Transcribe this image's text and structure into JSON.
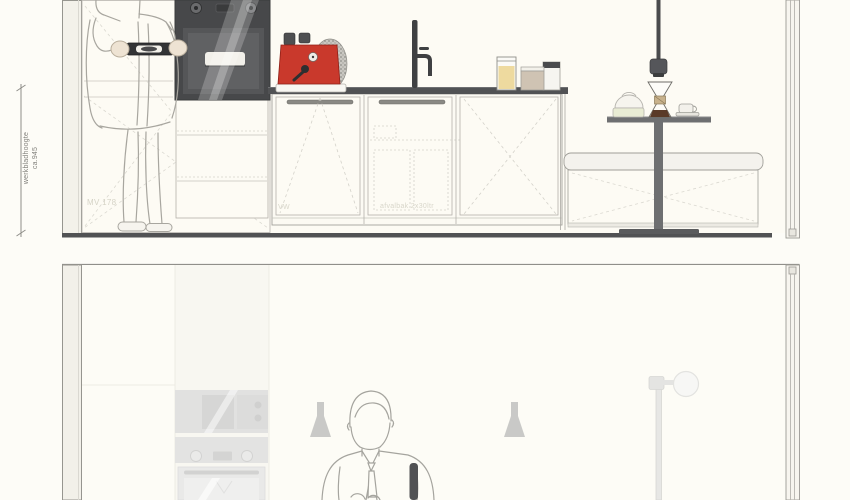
{
  "sheet": {
    "type": "kitchen-interior-elevation-drawing",
    "panels": [
      "front-elevation-with-figure",
      "side-elevation-ghosted-with-figure"
    ]
  },
  "annotations": {
    "worktop_height_label": "werkbladhoogte",
    "worktop_height_value": "ca.945",
    "tall_cabinet_label": "MV 178",
    "dishwasher_label": "VW",
    "waste_drawer_label": "afvalbak 2x30ltr"
  },
  "objects": {
    "top_panel": [
      "person-with-tray",
      "built-in-oven",
      "tall-cabinet",
      "drawer-stack",
      "countertop",
      "espresso-machine",
      "decorative-sphere",
      "kitchen-faucet",
      "storage-jars",
      "dishwasher",
      "sink-cabinet",
      "corner-cabinet",
      "pendant-light",
      "pedestal-table",
      "chemex-coffee-maker",
      "dome-dish",
      "cup-and-saucer",
      "bench",
      "wall-window-frame"
    ],
    "bottom_panel": [
      "ghosted-tall-cabinets",
      "ghosted-coffee-machine",
      "ghosted-oven",
      "pendant-lamp-left",
      "pendant-lamp-right",
      "person-figure",
      "kitchen-faucet",
      "ghosted-floor-lamp",
      "wall-window-frame"
    ]
  },
  "colors": {
    "background": "#fdfcf7",
    "panel_fill": "#fdfbf4",
    "outline": "#a9a8a2",
    "dark": "#515254",
    "oven_body": "#47484a",
    "espresso_red": "#c9392c",
    "jar_yellow": "#eeda9f",
    "jar_beige": "#cfc3b3",
    "wood_collar": "#c8b28c",
    "coffee_brown": "#5a3a28",
    "ghost_gray": "#e2e2e1",
    "figure_line": "#a5a49e",
    "lamp_silhouette": "#c9c9c7"
  }
}
